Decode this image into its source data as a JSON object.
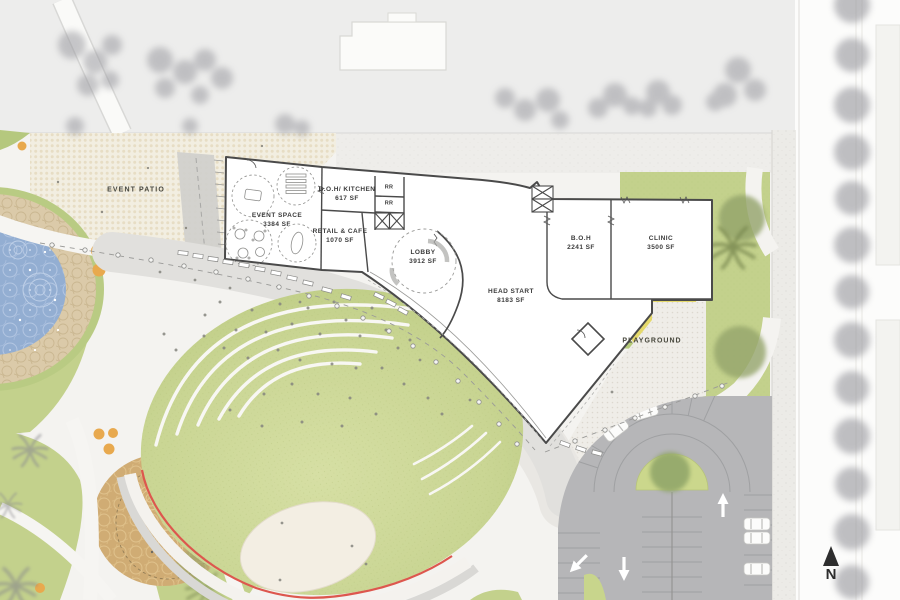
{
  "plan": {
    "site_labels": {
      "event_patio": "EVENT PATIO",
      "playground": "PLAYGROUND",
      "north_indicator": "N"
    },
    "rooms": [
      {
        "name": "EVENT SPACE",
        "area": "3384 SF"
      },
      {
        "name": "B.O.H/ KITCHEN",
        "area": "617 SF"
      },
      {
        "name": "RETAIL & CAFE",
        "area": "1070 SF"
      },
      {
        "name": "LOBBY",
        "area": "3912 SF"
      },
      {
        "name": "HEAD START",
        "area": "8183 SF"
      },
      {
        "name": "B.O.H",
        "area": "2241 SF"
      },
      {
        "name": "CLINIC",
        "area": "3500 SF"
      }
    ],
    "restrooms": [
      {
        "label": "RR"
      },
      {
        "label": "RR"
      }
    ],
    "colors": {
      "lawn_green": "#c3d18c",
      "pond_blue": "#93aed2",
      "pond_ring_tan": "#dbcaa9",
      "plaza_tan": "#d0ac74",
      "playground_yellow": "#e5d96b",
      "parking_gray": "#b6b6b8",
      "accent_red": "#dd574e",
      "accent_orange": "#e8a94e",
      "wall_dark": "#4a4a4a"
    }
  }
}
